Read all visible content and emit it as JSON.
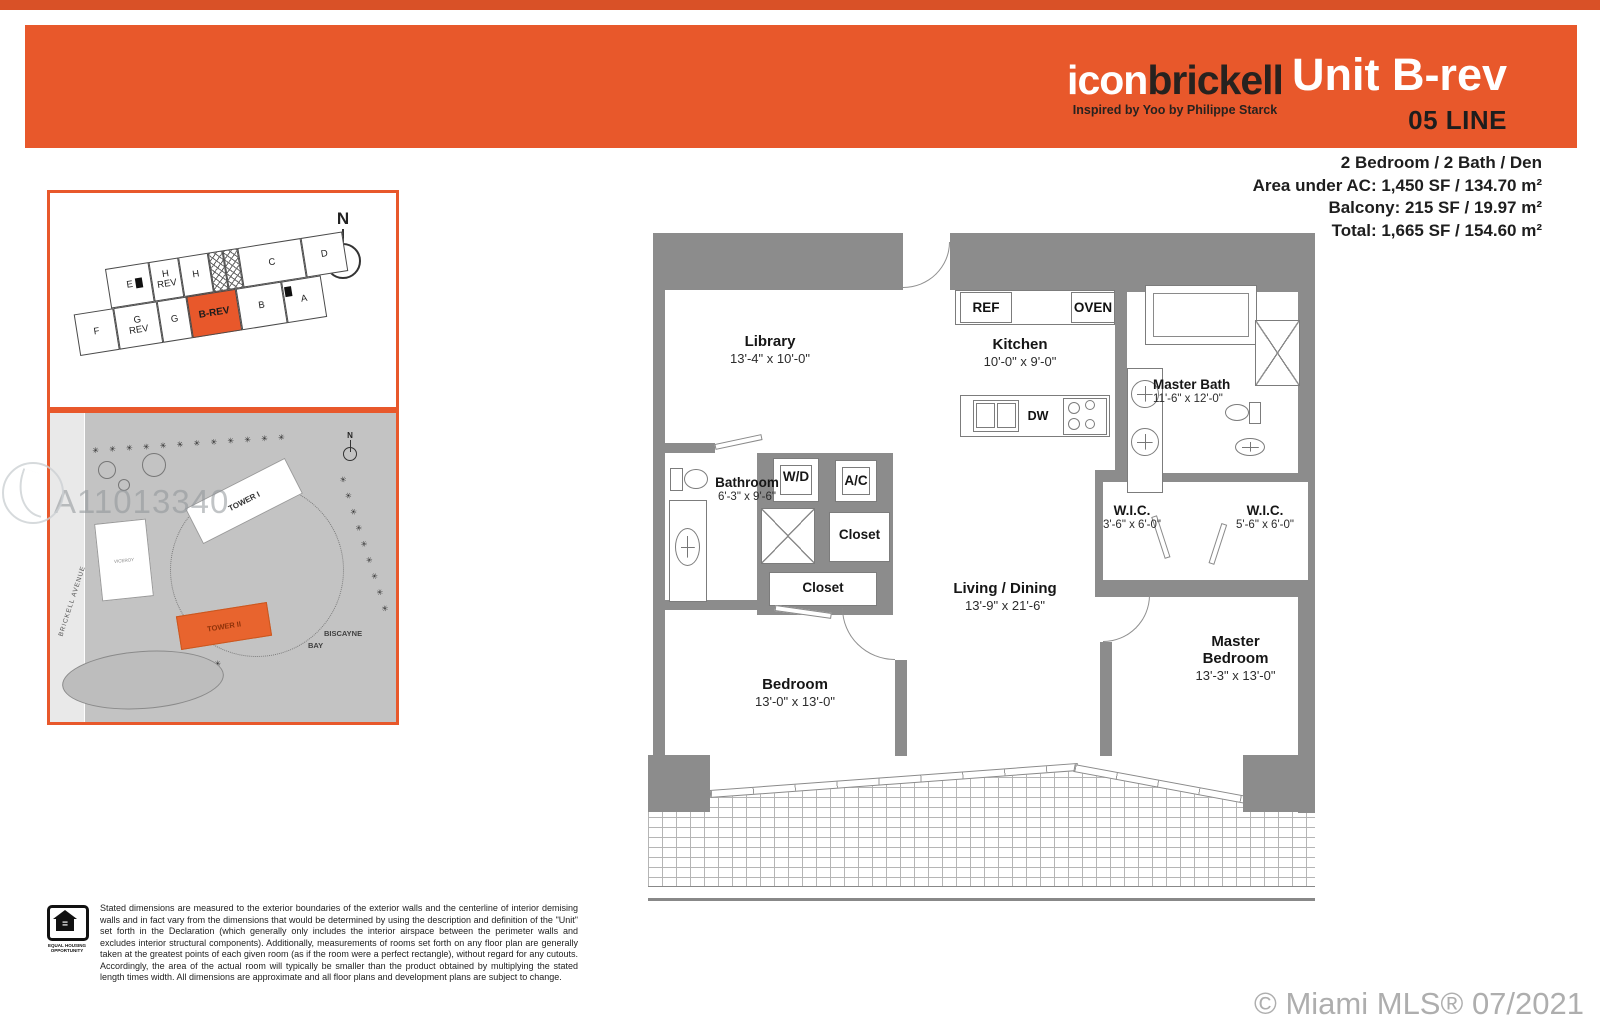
{
  "colors": {
    "accent_orange": "#e8582b",
    "top_strip_orange": "#d95127",
    "wall_gray": "#8c8c8c",
    "map_gray": "#c3c3c3",
    "copyright_gray": "#aeaeae"
  },
  "header": {
    "brand_icon": "icon",
    "brand_brickell": "brickell",
    "tagline": "Inspired by Yoo by Philippe Starck",
    "unit_title": "Unit B-rev",
    "line_label": "05 LINE"
  },
  "stats": {
    "line1": "2 Bedroom / 2 Bath / Den",
    "line2": "Area under AC: 1,450 SF / 134.70 m²",
    "line3": "Balcony: 215 SF / 19.97 m²",
    "line4": "Total: 1,665 SF / 154.60 m²"
  },
  "keyplan": {
    "north": "N",
    "units": {
      "e": "E",
      "h_rev": "H\nREV",
      "h": "H",
      "c": "C",
      "d": "D",
      "f": "F",
      "g_rev": "G\nREV",
      "g": "G",
      "b_rev": "B-REV",
      "b": "B",
      "a": "A"
    }
  },
  "siteplan": {
    "north": "N",
    "tower1": "TOWER I",
    "tower2": "TOWER II",
    "viceroy": "VICEROY",
    "street": "BRICKELL AVENUE",
    "bay_line1": "BISCAYNE",
    "bay_line2": "BAY",
    "watermark": "A11013340",
    "trees_top": "✳ ✳ ✳ ✳ ✳ ✳ ✳ ✳ ✳ ✳ ✳ ✳",
    "trees_right": "✳ ✳ ✳ ✳ ✳ ✳ ✳ ✳ ✳",
    "trees_bottom": "✳ ✳ ✳ ✳ ✳ ✳ ✳ ✳"
  },
  "floorplan": {
    "rooms": {
      "library": {
        "name": "Library",
        "dims": "13'-4\" x 10'-0\""
      },
      "kitchen": {
        "name": "Kitchen",
        "dims": "10'-0\" x 9'-0\""
      },
      "master_bath": {
        "name": "Master Bath",
        "dims": "11'-6\" x 12'-0\""
      },
      "bathroom": {
        "name": "Bathroom",
        "dims": "6'-3\" x 9'-6\""
      },
      "wd": {
        "name": "W/D"
      },
      "ac": {
        "name": "A/C"
      },
      "closet1": {
        "name": "Closet"
      },
      "closet2": {
        "name": "Closet"
      },
      "wic_small": {
        "name": "W.I.C.",
        "dims": "3'-6\" x 6'-0\""
      },
      "wic_large": {
        "name": "W.I.C.",
        "dims": "5'-6\" x 6'-0\""
      },
      "living": {
        "name": "Living / Dining",
        "dims": "13'-9\" x 21'-6\""
      },
      "bedroom": {
        "name": "Bedroom",
        "dims": "13'-0\" x 13'-0\""
      },
      "master_bedroom": {
        "name": "Master\nBedroom",
        "dims": "13'-3\" x 13'-0\""
      }
    },
    "appliances": {
      "ref": "REF",
      "oven": "OVEN",
      "dw": "DW"
    }
  },
  "footer": {
    "disclaimer": "Stated dimensions are measured to the exterior boundaries of the exterior walls and the centerline of interior demising walls and in fact vary from the dimensions that would be determined by using the description and definition of the \"Unit\" set forth in the Declaration (which generally only includes the interior airspace between the perimeter walls and excludes interior structural components). Additionally, measurements of rooms set forth on any floor plan are generally taken at the greatest points of each given room (as if the room were a perfect rectangle), without regard for any cutouts. Accordingly, the area of the actual room will typically be smaller than the product obtained by multiplying the stated length times width. All dimensions are approximate and all floor plans and development plans are subject to change.",
    "equal_housing_caption": "EQUAL HOUSING OPPORTUNITY",
    "copyright": "© Miami MLS® 07/2021"
  }
}
